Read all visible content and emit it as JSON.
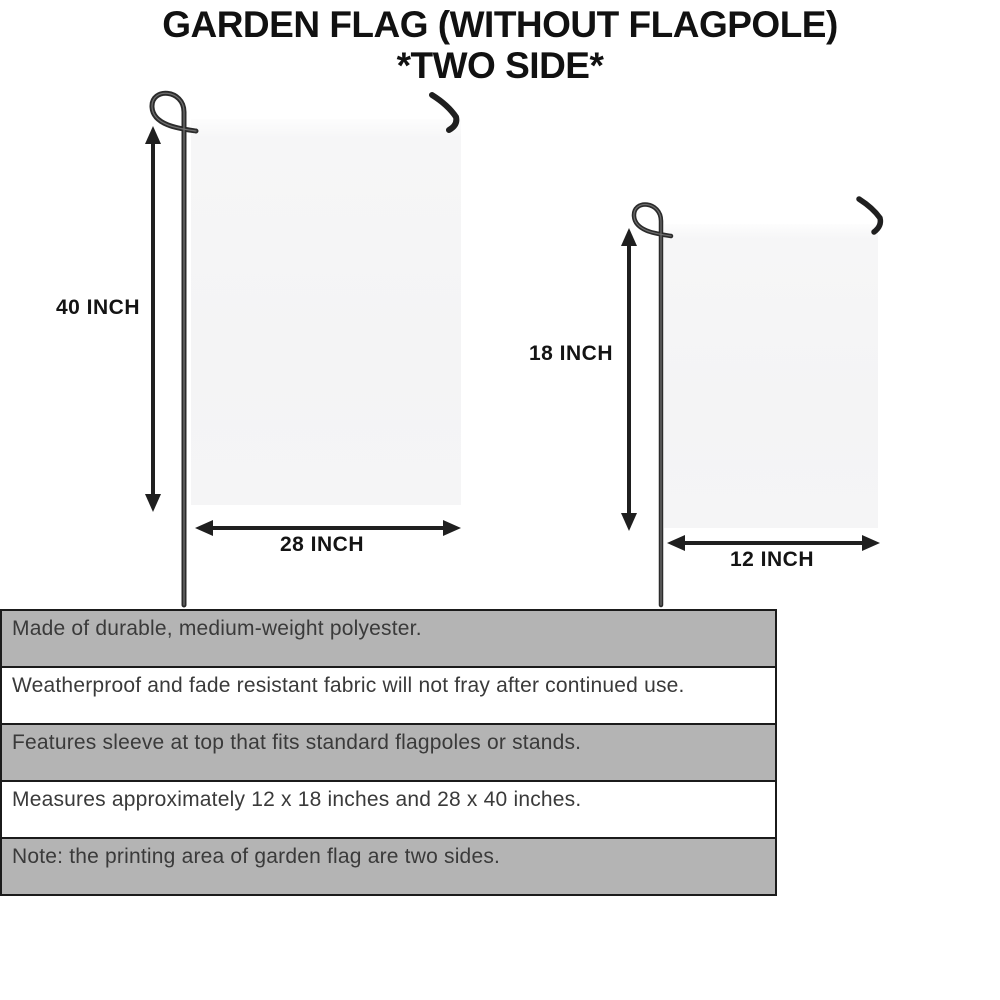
{
  "title": {
    "line1": "GARDEN FLAG (WITHOUT FLAGPOLE)",
    "line2": "*TWO SIDE*"
  },
  "diagram": {
    "large_flag": {
      "height_label": "40 INCH",
      "width_label": "28 INCH"
    },
    "small_flag": {
      "height_label": "18 INCH",
      "width_label": "12 INCH"
    }
  },
  "features": [
    "Made of durable, medium-weight polyester.",
    "Weatherproof and fade resistant fabric will not fray after continued use.",
    "Features sleeve at top that fits standard flagpoles or stands.",
    "Measures approximately 12 x 18 inches and 28 x 40 inches.",
    "Note: the printing area of garden flag are two sides."
  ],
  "colors": {
    "row_gray": "#b4b4b4",
    "row_white": "#ffffff",
    "flag_fill": "#f5f5f6",
    "line_black": "#1f1f1f",
    "pole_dark": "#2b2b2b",
    "text_dark": "#3a3a3a"
  }
}
